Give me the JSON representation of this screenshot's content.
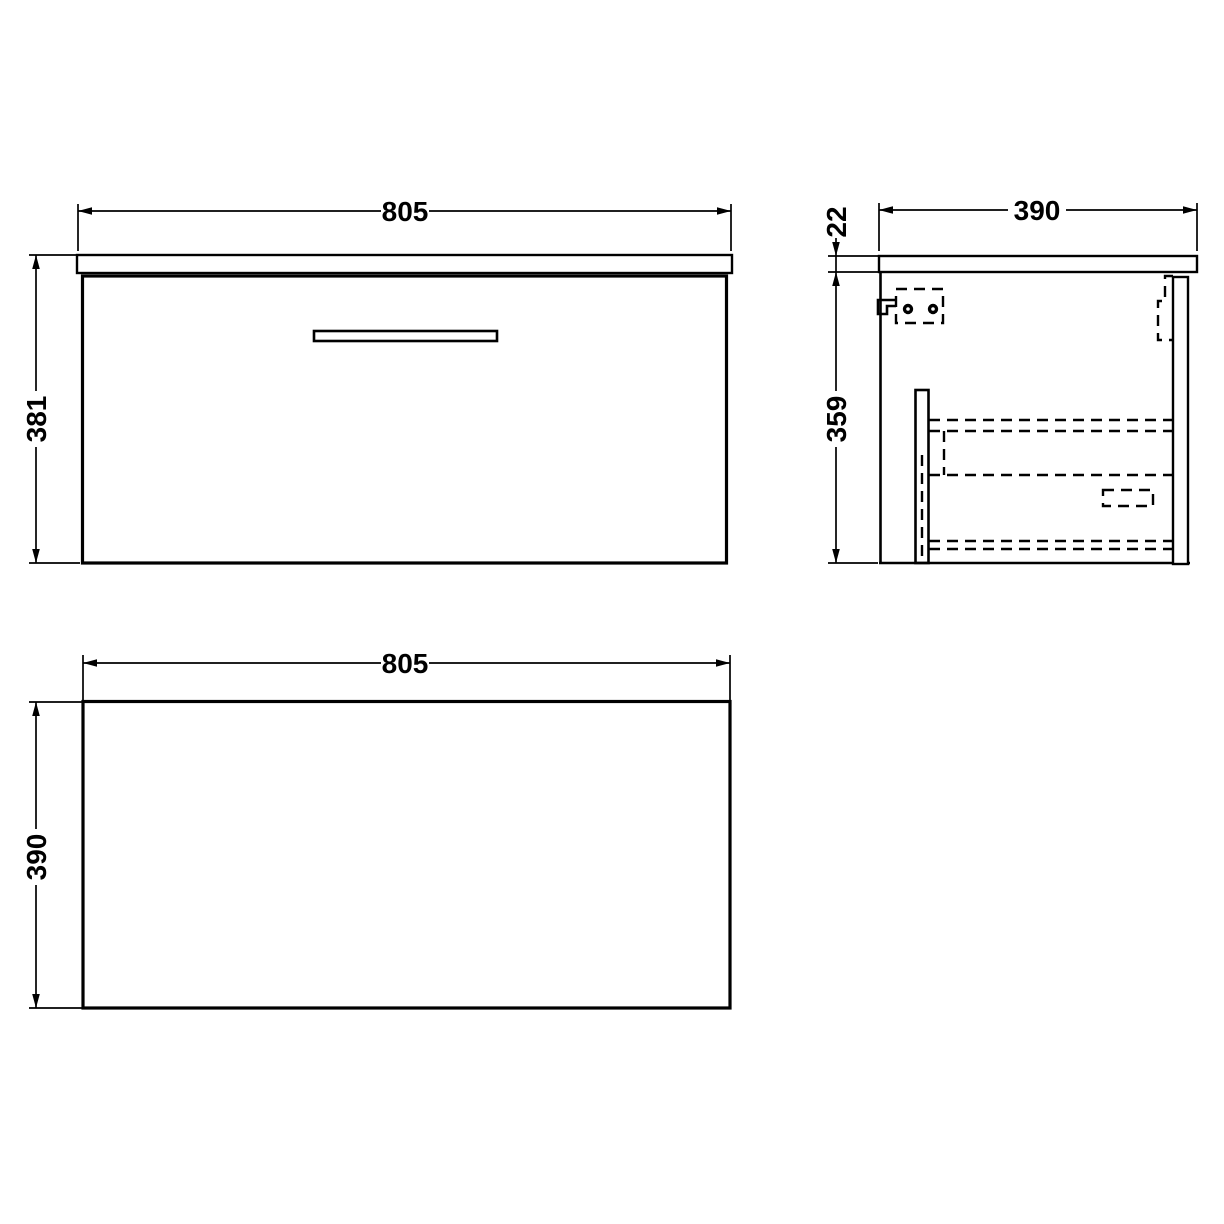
{
  "page": {
    "background_color": "#ffffff",
    "line_color": "#000000"
  },
  "views": {
    "front": {
      "width_mm": "805",
      "height_mm": "381"
    },
    "side": {
      "depth_mm": "390",
      "worktop_thickness_mm": "22",
      "cabinet_height_mm": "359"
    },
    "plan": {
      "width_mm": "805",
      "depth_mm": "390"
    }
  }
}
